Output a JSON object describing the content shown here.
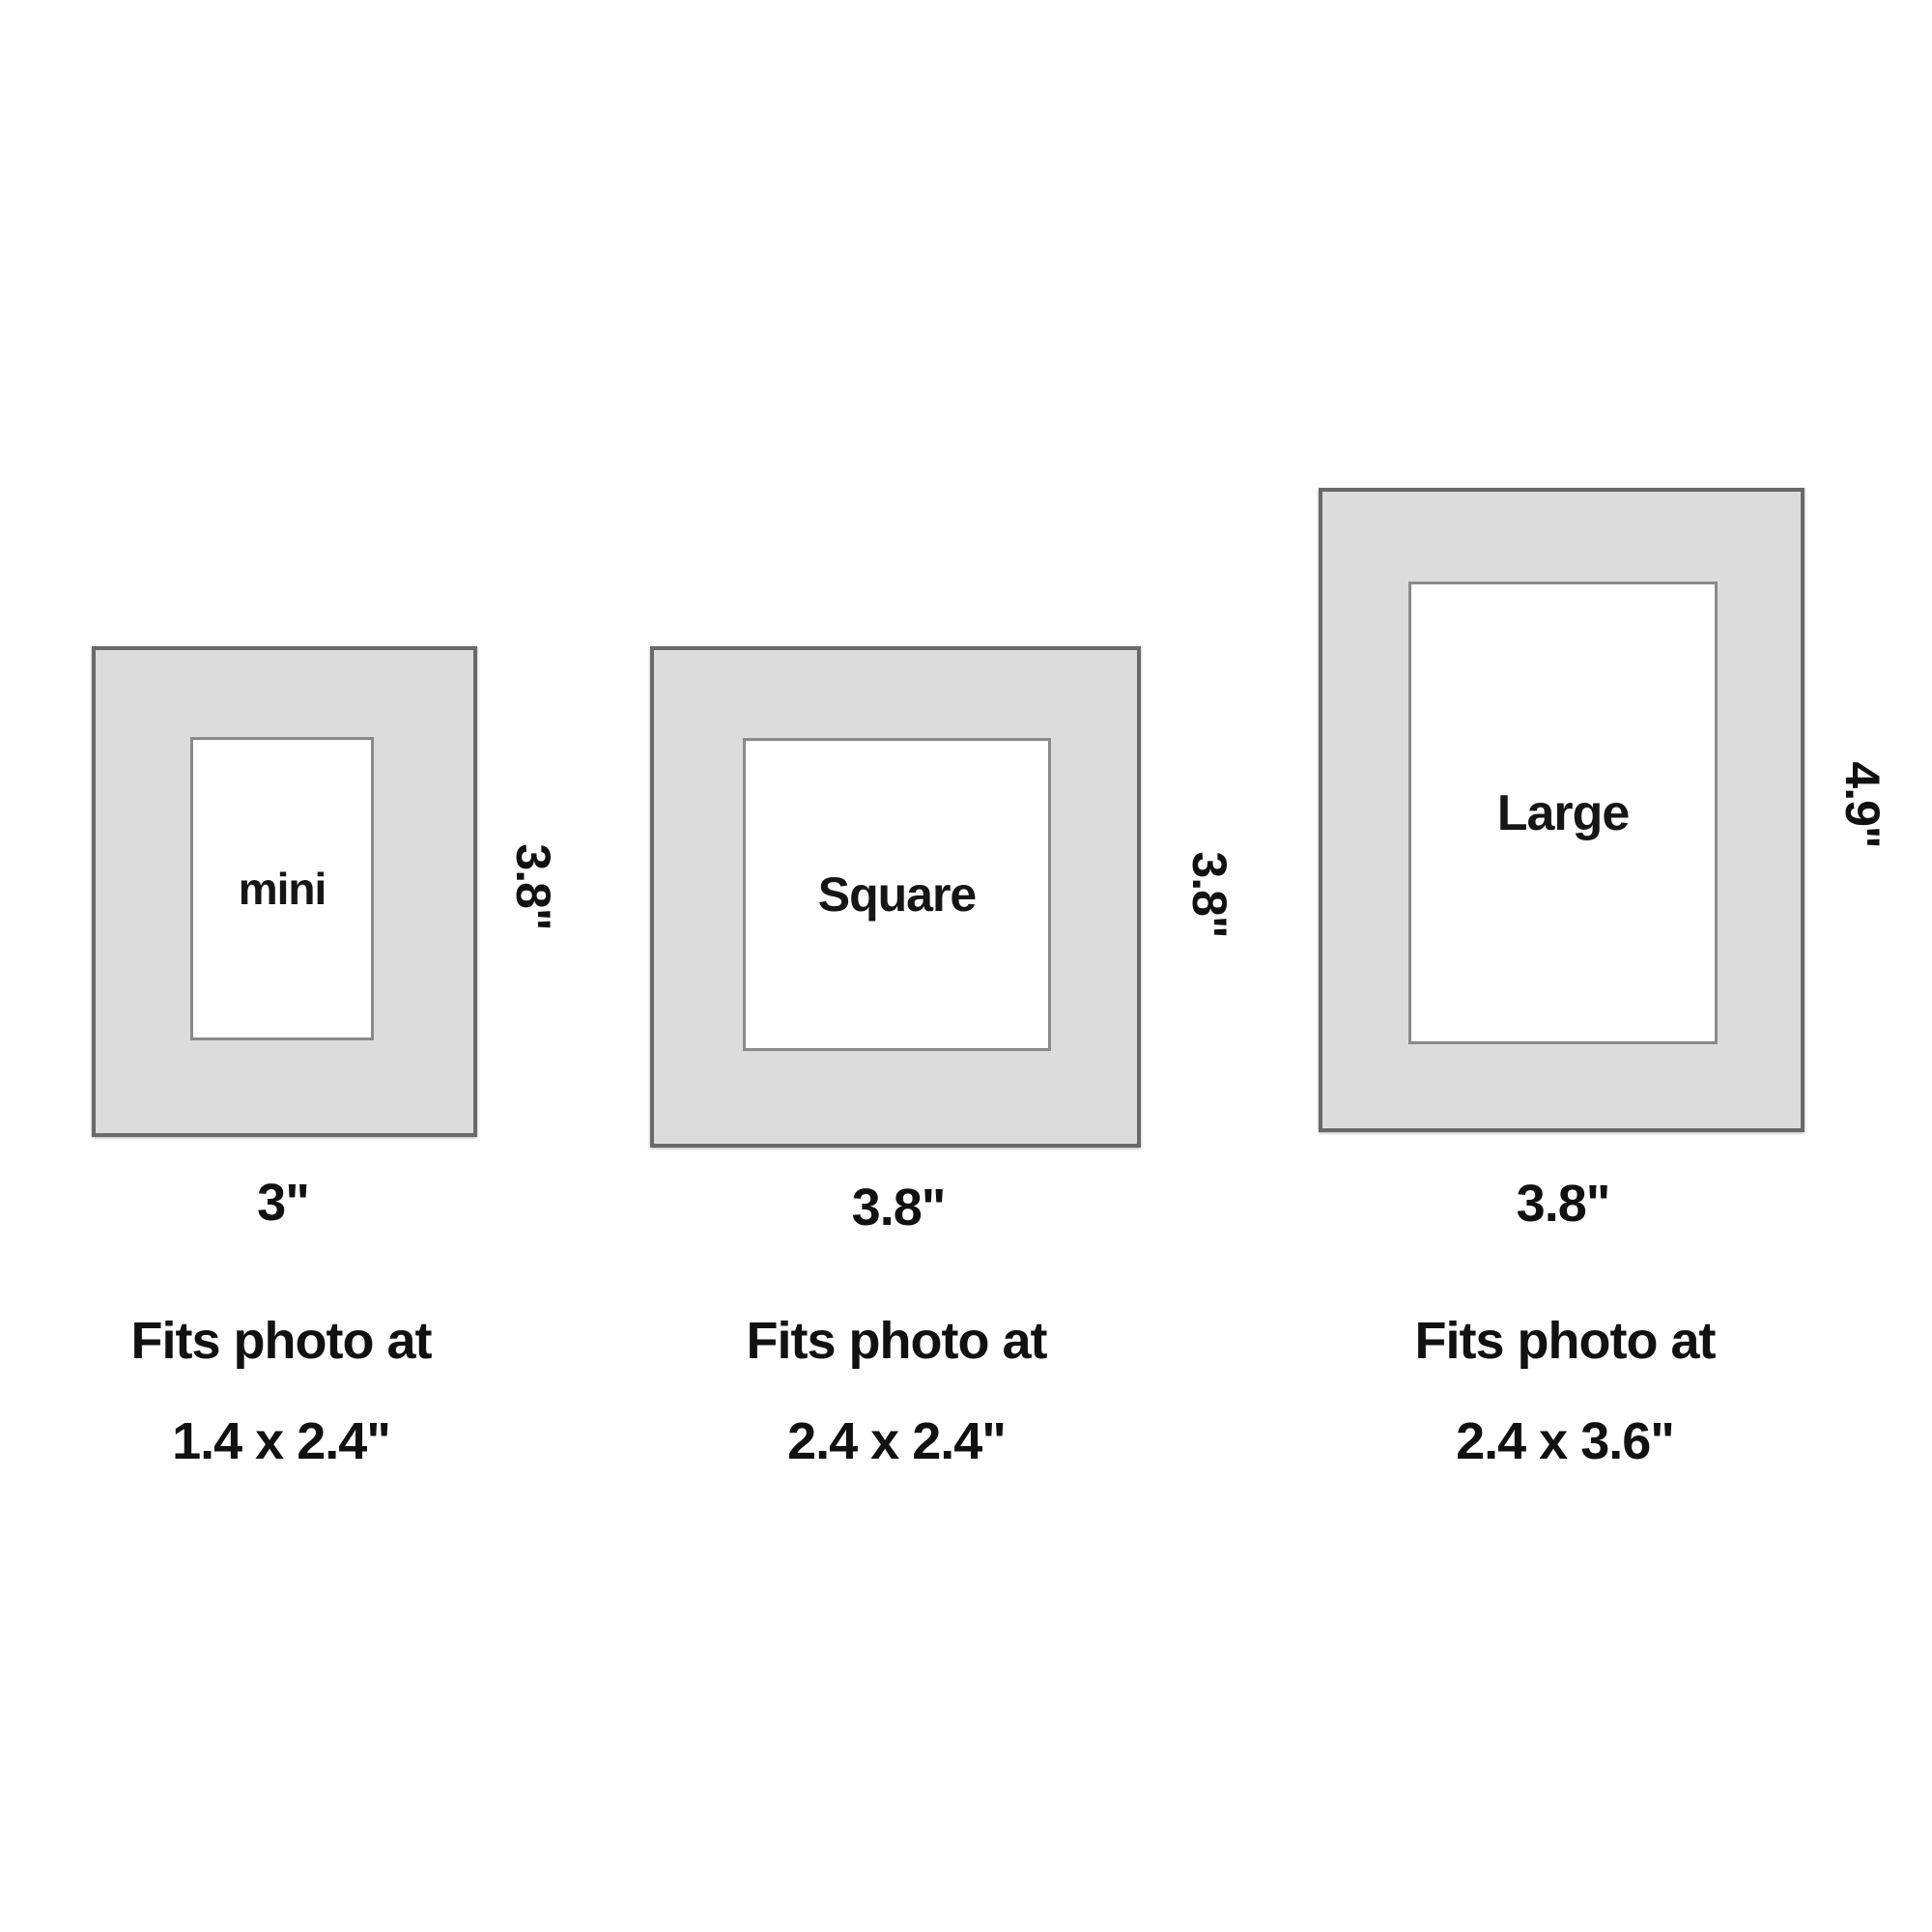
{
  "colors": {
    "background": "#ffffff",
    "mat_fill": "#dcdcdc",
    "mat_border": "#696969",
    "opening_border": "#8a8a8a",
    "text": "#111111"
  },
  "frames": [
    {
      "name": "mini",
      "side_label": "3.8\"",
      "bottom_label": "3\"",
      "fits_caption": "Fits photo at",
      "fits_size": "1.4 x 2.4\""
    },
    {
      "name": "Square",
      "side_label": "3.8\"",
      "bottom_label": "3.8\"",
      "fits_caption": "Fits photo at",
      "fits_size": "2.4 x 2.4\""
    },
    {
      "name": "Large",
      "side_label": "4.9\"",
      "bottom_label": "3.8\"",
      "fits_caption": "Fits photo at",
      "fits_size": "2.4 x 3.6\""
    }
  ]
}
